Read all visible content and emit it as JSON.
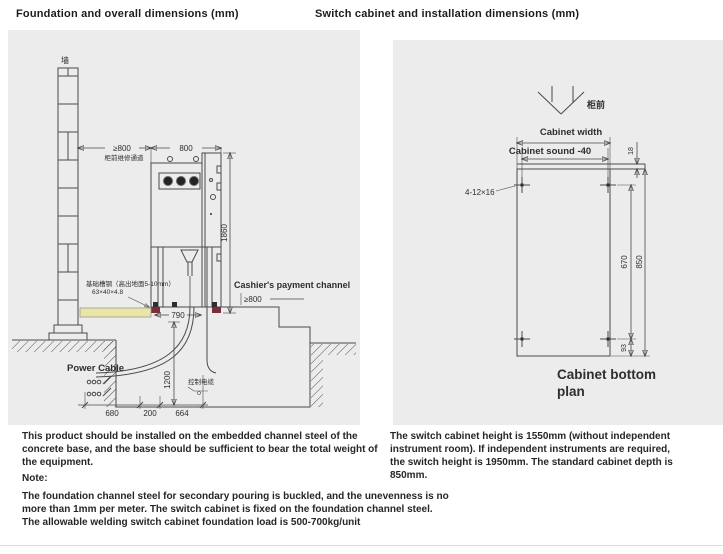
{
  "titles": {
    "left": "Foundation and overall dimensions (mm)",
    "right": "Switch cabinet and installation dimensions (mm)"
  },
  "left_drawing": {
    "wall_label": "墙",
    "aisle_dim": "≥800",
    "aisle_note": "柜前维修通道",
    "cabinet_width_dim": "800",
    "cabinet_height_dim": "1860",
    "cashier_channel_label": "Cashier's payment channel",
    "cashier_channel_dim": "≥800",
    "base_width_dim": "790",
    "channel_steel_note": "基础槽钢（高出地面5-10mm）",
    "channel_steel_size": "63×40×4.8",
    "power_cable_label": "Power Cable",
    "trench_depth_dim": "1200",
    "control_cable_label": "控制电缆",
    "trench_dims": [
      "680",
      "200",
      "664"
    ]
  },
  "right_drawing": {
    "front_marker_label": "柜前",
    "width_label": "Cabinet width",
    "depth_label": "Cabinet sound -40",
    "steel_height_dim": "18",
    "mounting_holes_label": "4-12×16",
    "hole_span_dim": "670",
    "cabinet_depth_dim": "850",
    "rear_offset_dim": "93",
    "caption_line1": "Cabinet bottom",
    "caption_line2": "plan"
  },
  "notes": {
    "installation": "This product should be installed on the embedded channel steel of the\nconcrete base, and the base should be sufficient to bear the total weight of\nthe equipment.",
    "note_heading": "Note:",
    "note_body": "The foundation channel steel for secondary pouring is buckled, and the unevenness is no\nmore than 1mm per meter. The switch cabinet is fixed on the foundation channel steel.\nThe allowable welding switch cabinet foundation load is 500-700kg/unit",
    "cabinet_spec": "The switch cabinet height is 1550mm (without independent\ninstrument room). If independent instruments are required,\nthe switch height is 1950mm. The standard cabinet depth is\n850mm."
  },
  "colors": {
    "panel_bg": "#ececec",
    "line": "#4a4a4a",
    "text": "#262626",
    "channel_steel_highlight": "#e9e6a6",
    "cabinet_foot": "#7c2d3a"
  }
}
